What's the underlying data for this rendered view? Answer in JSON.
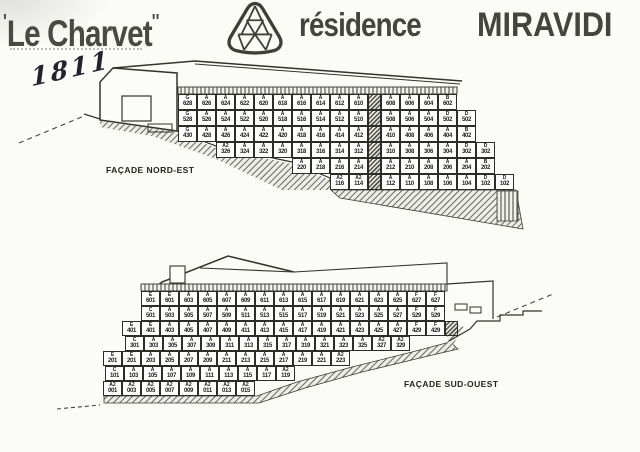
{
  "page": {
    "quote_open": "'",
    "title": "Le Charvet",
    "primes": "''",
    "brand": "résidence",
    "brand_name": "MIRAVIDI",
    "handwritten_number": "1811"
  },
  "colors": {
    "ink": "#2d2d27",
    "paper": "#fbfbf8",
    "header_ink": "#454540"
  },
  "logo": {
    "icon": "geodesic-triangle"
  },
  "facades": [
    {
      "id": "nord_est",
      "label": "FAÇADE NORD-EST",
      "rows": [
        {
          "cells": [
            "G 628",
            "A 626",
            "A 624",
            "A 622",
            "A 620",
            "A 618",
            "A 616",
            "A 614",
            "A 612",
            "A 610",
            "HATCH",
            "A 608",
            "A 606",
            "A 604",
            "B 602"
          ]
        },
        {
          "cells": [
            "G 528",
            "A 526",
            "A 524",
            "A 522",
            "A 520",
            "A 518",
            "A 516",
            "A 514",
            "A 512",
            "A 510",
            "HATCH",
            "A 508",
            "A 506",
            "A 504",
            "D 502",
            "D 502"
          ]
        },
        {
          "cells": [
            "G 430",
            "A 428",
            "A 426",
            "A 424",
            "A 422",
            "A 420",
            "A 418",
            "A 416",
            "A 414",
            "A 412",
            "HATCH",
            "A 410",
            "A 408",
            "A 406",
            "A 404",
            "B 402"
          ]
        },
        {
          "cells": [
            "A2 326",
            "A 324",
            "A 322",
            "A 320",
            "A 318",
            "A 316",
            "A 314",
            "A 312",
            "HATCH",
            "A 310",
            "A 308",
            "A 306",
            "A 304",
            "D 302",
            "D 302"
          ]
        },
        {
          "cells": [
            "A 220",
            "A 218",
            "A 216",
            "A 214",
            "HATCH",
            "A 212",
            "A 210",
            "A 208",
            "A 206",
            "A 204",
            "B 202"
          ]
        },
        {
          "cells": [
            "A2 116",
            "A2 114",
            "HATCH",
            "A 112",
            "A 110",
            "A 108",
            "A 106",
            "A 104",
            "D 102",
            "D 102"
          ]
        }
      ]
    },
    {
      "id": "sud_ouest",
      "label": "FAÇADE SUD-OUEST",
      "rows": [
        {
          "cells": [
            "E 601",
            "E 601",
            "A 603",
            "A 605",
            "A 607",
            "A 609",
            "A 611",
            "A 613",
            "A 615",
            "A 617",
            "A 619",
            "A 621",
            "A 623",
            "A 625",
            "F 627",
            "F 627"
          ]
        },
        {
          "cells": [
            "C 501",
            "A 503",
            "A 505",
            "A 507",
            "A 509",
            "A 511",
            "A 513",
            "A 515",
            "A 517",
            "A 519",
            "A 521",
            "A 523",
            "A 525",
            "A 527",
            "F 529",
            "F 529"
          ]
        },
        {
          "cells": [
            "E 401",
            "E 401",
            "A 403",
            "A 405",
            "A 407",
            "A 409",
            "A 411",
            "A 413",
            "A 415",
            "A 417",
            "A 419",
            "A 421",
            "A 423",
            "A 425",
            "A 427",
            "F 429",
            "F 429",
            "HATCH"
          ]
        },
        {
          "cells": [
            "C 301",
            "A 303",
            "A 305",
            "A 307",
            "A 309",
            "A 311",
            "A 313",
            "A 315",
            "A 317",
            "A 319",
            "A 321",
            "A 323",
            "A 325",
            "A2 327",
            "A2 329"
          ]
        },
        {
          "cells": [
            "E 201",
            "E 201",
            "A 203",
            "A 205",
            "A 207",
            "A 209",
            "A 211",
            "A 213",
            "A 215",
            "A 217",
            "A 219",
            "A 221",
            "A2 223"
          ]
        },
        {
          "cells": [
            "C 101",
            "A 103",
            "A 105",
            "A 107",
            "A 109",
            "A 111",
            "A 113",
            "A 115",
            "A 117",
            "A2 119"
          ]
        },
        {
          "cells": [
            "A2 001",
            "A2 003",
            "A2 005",
            "A2 007",
            "A2 009",
            "A2 011",
            "A2 013",
            "A2 015"
          ]
        }
      ]
    }
  ]
}
